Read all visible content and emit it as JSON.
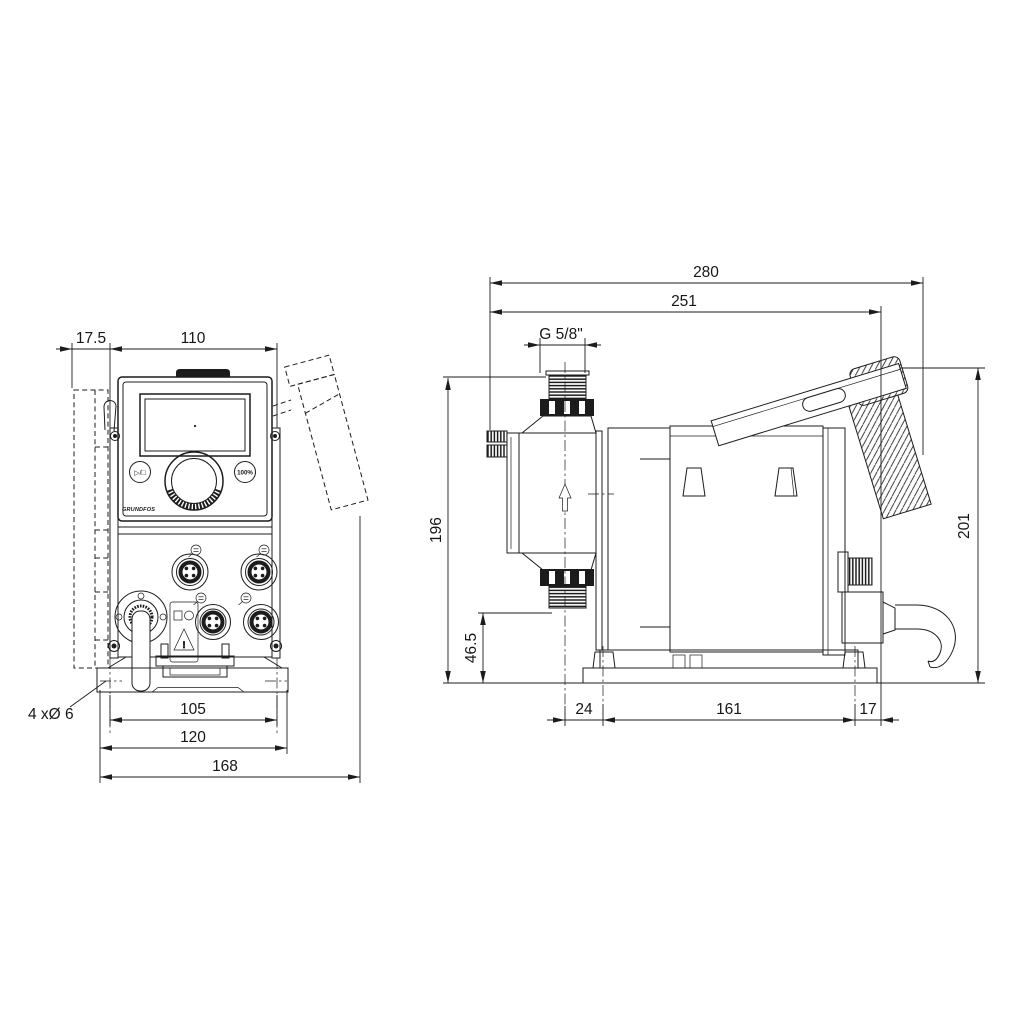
{
  "front_view": {
    "dimensions": {
      "bracket_offset": "17.5",
      "panel_width": "110",
      "hole_pitch": "105",
      "base_width": "120",
      "overall_width": "168",
      "mounting_holes_note": "4 xØ 6"
    },
    "panel": {
      "start_stop_button": "▷/□",
      "capacity_button": "100%",
      "brand": "GRUNDFOS",
      "warning_mark": "!"
    }
  },
  "side_view": {
    "dimensions": {
      "overall_depth": "280",
      "depth_to_connector": "251",
      "connection_thread": "G 5/8\"",
      "outlet_height": "196",
      "inlet_height": "46.5",
      "head_offset": "24",
      "foot_pitch": "161",
      "rear_offset": "17",
      "overall_height": "201"
    }
  }
}
